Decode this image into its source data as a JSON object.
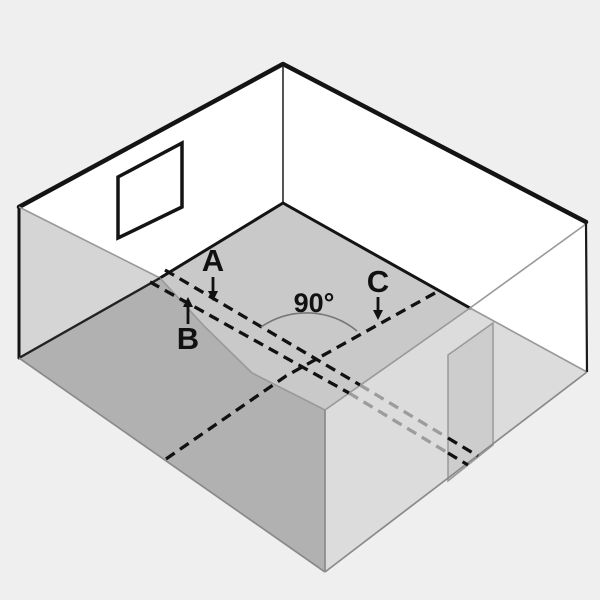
{
  "diagram": {
    "labels": {
      "line_a": "A",
      "line_b": "B",
      "line_c": "C",
      "angle": "90°"
    },
    "colors": {
      "background": "#efefef",
      "wall": "#ffffff",
      "floor": "#c9c9c9",
      "near_left_wall": "#b1b1b1",
      "near_left_wall_top": "#d5d5d5",
      "near_right_wall": "#dcdcdc",
      "door": "#cdcdcd",
      "chalk_line": "#111111",
      "chalk_line_faded": "#9c9c9c"
    }
  }
}
